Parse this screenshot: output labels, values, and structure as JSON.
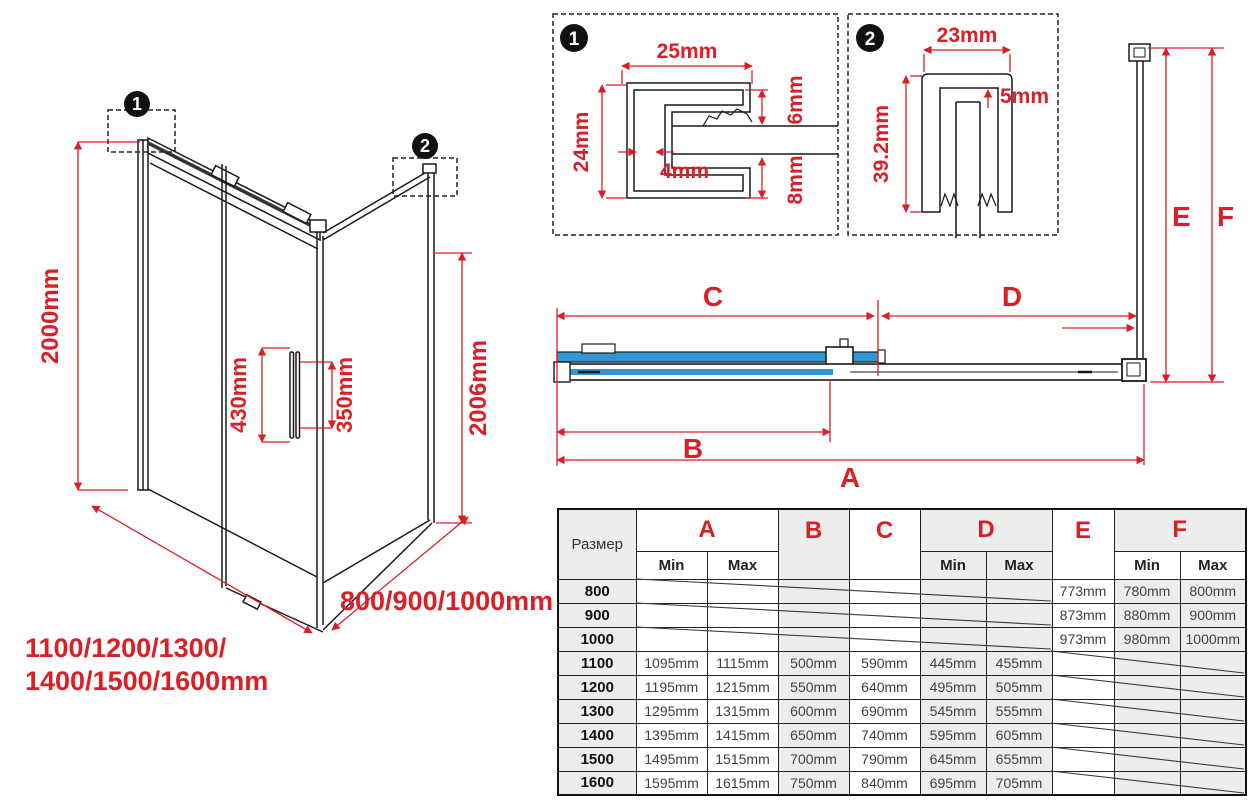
{
  "colors": {
    "accent_red": "#da1f26",
    "glass_blue": "#2e96d2",
    "table_gray": "#ededed",
    "line_black": "#1a1a1a"
  },
  "iso": {
    "badge1": "1",
    "badge2": "2",
    "dim_height_left": "2000mm",
    "dim_height_right": "2006mm",
    "dim_handle_outer": "430mm",
    "dim_handle_inner": "350mm",
    "dim_width_front_line1": "1100/1200/1300/",
    "dim_width_front_line2": "1400/1500/1600mm",
    "dim_width_side": "800/900/1000mm"
  },
  "detail1": {
    "badge": "1",
    "dim_top": "25mm",
    "dim_left": "24mm",
    "dim_inner": "4mm",
    "dim_right_top": "6mm",
    "dim_right_bottom": "8mm"
  },
  "detail2": {
    "badge": "2",
    "dim_top": "23mm",
    "dim_inner": "5mm",
    "dim_left": "39.2mm"
  },
  "plan": {
    "label_a": "A",
    "label_b": "B",
    "label_c": "C",
    "label_d": "D",
    "label_e": "E",
    "label_f": "F"
  },
  "table": {
    "size_header": "Размер",
    "min_label": "Min",
    "max_label": "Max",
    "letters": {
      "a": "A",
      "b": "B",
      "c": "C",
      "d": "D",
      "e": "E",
      "f": "F"
    },
    "rows": [
      {
        "size": "800",
        "a_min": "",
        "a_max": "",
        "b": "",
        "c": "",
        "d_min": "",
        "d_max": "",
        "e": "773mm",
        "f_min": "780mm",
        "f_max": "800mm"
      },
      {
        "size": "900",
        "a_min": "",
        "a_max": "",
        "b": "",
        "c": "",
        "d_min": "",
        "d_max": "",
        "e": "873mm",
        "f_min": "880mm",
        "f_max": "900mm"
      },
      {
        "size": "1000",
        "a_min": "",
        "a_max": "",
        "b": "",
        "c": "",
        "d_min": "",
        "d_max": "",
        "e": "973mm",
        "f_min": "980mm",
        "f_max": "1000mm"
      },
      {
        "size": "1100",
        "a_min": "1095mm",
        "a_max": "1115mm",
        "b": "500mm",
        "c": "590mm",
        "d_min": "445mm",
        "d_max": "455mm",
        "e": "",
        "f_min": "",
        "f_max": ""
      },
      {
        "size": "1200",
        "a_min": "1195mm",
        "a_max": "1215mm",
        "b": "550mm",
        "c": "640mm",
        "d_min": "495mm",
        "d_max": "505mm",
        "e": "",
        "f_min": "",
        "f_max": ""
      },
      {
        "size": "1300",
        "a_min": "1295mm",
        "a_max": "1315mm",
        "b": "600mm",
        "c": "690mm",
        "d_min": "545mm",
        "d_max": "555mm",
        "e": "",
        "f_min": "",
        "f_max": ""
      },
      {
        "size": "1400",
        "a_min": "1395mm",
        "a_max": "1415mm",
        "b": "650mm",
        "c": "740mm",
        "d_min": "595mm",
        "d_max": "605mm",
        "e": "",
        "f_min": "",
        "f_max": ""
      },
      {
        "size": "1500",
        "a_min": "1495mm",
        "a_max": "1515mm",
        "b": "700mm",
        "c": "790mm",
        "d_min": "645mm",
        "d_max": "655mm",
        "e": "",
        "f_min": "",
        "f_max": ""
      },
      {
        "size": "1600",
        "a_min": "1595mm",
        "a_max": "1615mm",
        "b": "750mm",
        "c": "840mm",
        "d_min": "695mm",
        "d_max": "705mm",
        "e": "",
        "f_min": "",
        "f_max": ""
      }
    ]
  }
}
